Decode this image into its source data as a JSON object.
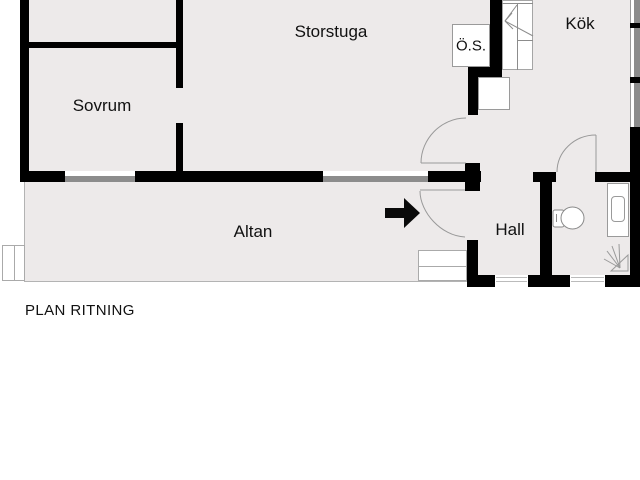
{
  "title": "PLAN RITNING",
  "rooms": {
    "storstuga": "Storstuga",
    "sovrum": "Sovrum",
    "os": "Ö.S.",
    "kok": "Kök",
    "hall": "Hall",
    "altan": "Altan"
  },
  "icons": {
    "stairs": "stairs-icon",
    "toilet": "toilet-icon",
    "sink": "sink-icon",
    "shower": "shower-icon",
    "entrance_arrow": "entrance-arrow-icon",
    "door_swing": "door-swing-arc",
    "window": "window-marker"
  },
  "colors": {
    "wall": "#000000",
    "floor": "#edeaea",
    "window_gray": "#8c8c8c",
    "outline_gray": "#999999",
    "background": "#ffffff",
    "text": "#111111"
  }
}
